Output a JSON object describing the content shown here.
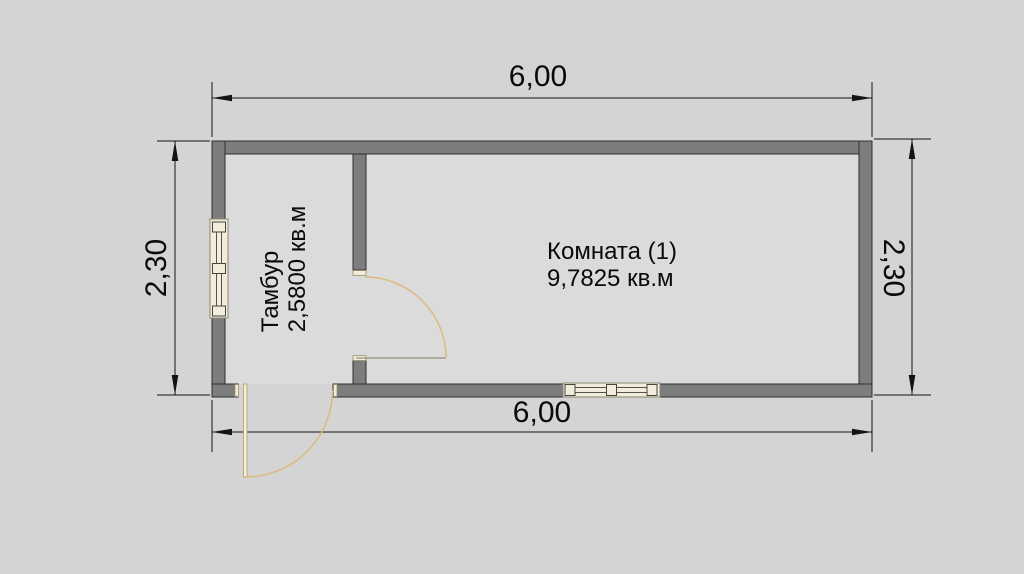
{
  "floorplan": {
    "drawing_type": "floor plan",
    "rooms": [
      {
        "name": "Тамбур",
        "area": "2,5800 кв.м"
      },
      {
        "name": "Комната (1)",
        "area": "9,7825 кв.м"
      }
    ],
    "dimensions": {
      "top": "6,00",
      "bottom": "6,00",
      "left": "2,30",
      "right": "2,30"
    },
    "colors": {
      "background": "#d4d4d4",
      "interior": "#dbdbdb",
      "wall_fill": "#7d7d7d",
      "wall_outline": "#2f2f2f",
      "window_fill": "#f2ecda",
      "window_outline": "#8b8574",
      "door_arc": "#dcb879",
      "dimension_line": "#141414",
      "text": "#0a0a0a"
    }
  }
}
